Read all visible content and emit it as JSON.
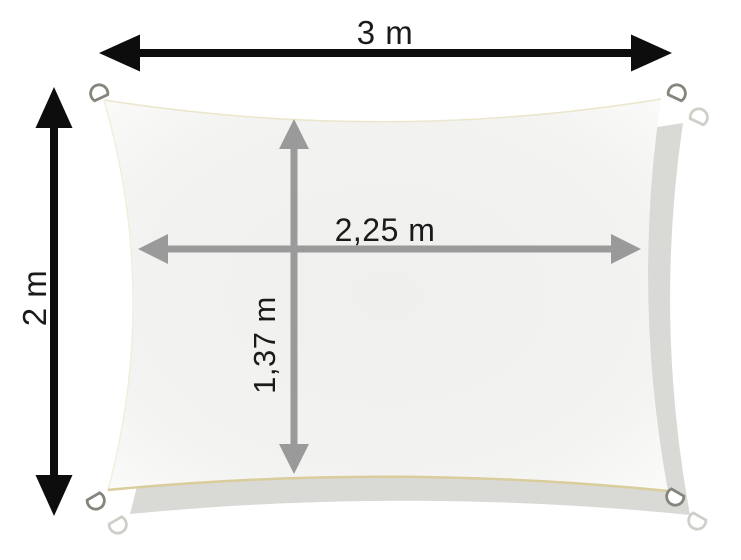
{
  "diagram": {
    "name": "sun-shade-sail-dimension-diagram",
    "outer_width_label": "3 m",
    "outer_height_label": "2 m",
    "inner_width_label": "2,25 m",
    "inner_height_label": "1,37 m",
    "colors": {
      "background": "#ffffff",
      "outer_arrow": "#0d0d0d",
      "inner_arrow": "#9a9a9a",
      "label_color": "#1a1a1a",
      "sail_center": "#efefed",
      "sail_mid": "#f3f3f1",
      "sail_edge": "#fbfbfa",
      "shadow": "#d9d9d6",
      "bottom_trim": "#d9cd9b",
      "top_trim": "#ebe7cd",
      "left_trim": "#f1edda",
      "ring_stroke": "#85857d",
      "ring_fill": "#ffffff",
      "shadow_ring_stroke": "#cfcfca"
    }
  }
}
